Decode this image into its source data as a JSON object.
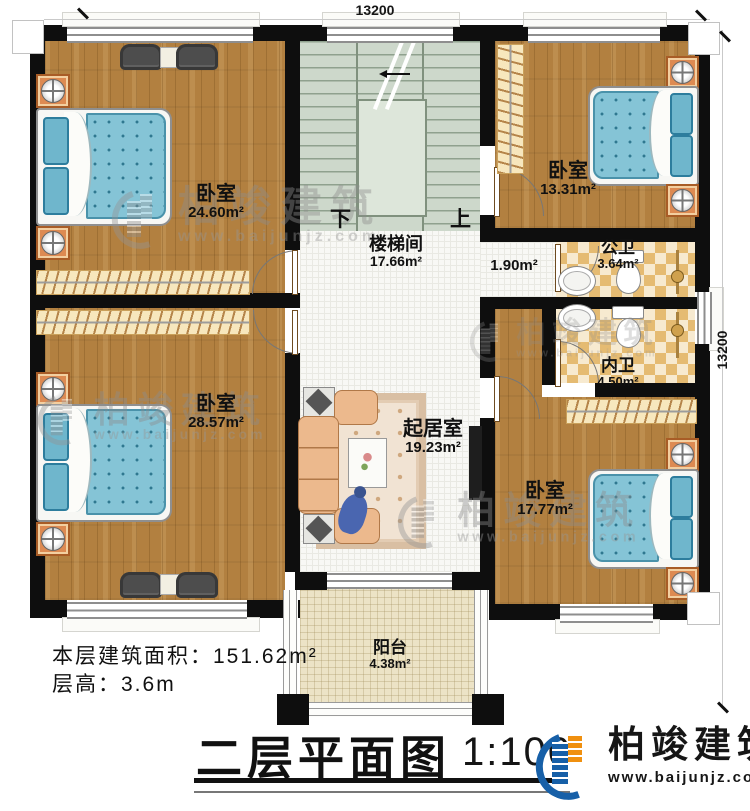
{
  "dimensions": {
    "top": "13200",
    "right": "13200"
  },
  "rooms": {
    "bedroom_tl": {
      "name": "卧室",
      "area": "24.60m²"
    },
    "bedroom_bl": {
      "name": "卧室",
      "area": "28.57m²"
    },
    "bedroom_tr": {
      "name": "卧室",
      "area": "13.31m²"
    },
    "bedroom_br": {
      "name": "卧室",
      "area": "17.77m²"
    },
    "stairwell": {
      "name": "楼梯间",
      "area": "17.66m²"
    },
    "living": {
      "name": "起居室",
      "area": "19.23m²"
    },
    "public_bath": {
      "name": "公卫",
      "area": "3.64m²"
    },
    "inner_bath": {
      "name": "内卫",
      "area": "4.50m²"
    },
    "balcony": {
      "name": "阳台",
      "area": "4.38m²"
    },
    "hall": {
      "area": "1.90m²"
    }
  },
  "stairs": {
    "down": "下",
    "up": "上"
  },
  "footer": {
    "area_label": "本层建筑面积：",
    "area_value": "151.62m²",
    "height_label": "层高：",
    "height_value": "3.6m"
  },
  "title": {
    "text": "二层平面图",
    "scale": "1:100"
  },
  "brand": {
    "name": "柏竣建筑",
    "url": "www.baijunjz.com"
  },
  "watermark": {
    "name": "柏竣建筑",
    "url": "www.baijunjz.com"
  },
  "colors": {
    "wood": "#b28040",
    "stair": "#cdd8cb",
    "bath_tile": "#e5bb72",
    "bed": "#85c4d6",
    "brand_blue": "#1760a8",
    "brand_orange": "#f0900f"
  }
}
